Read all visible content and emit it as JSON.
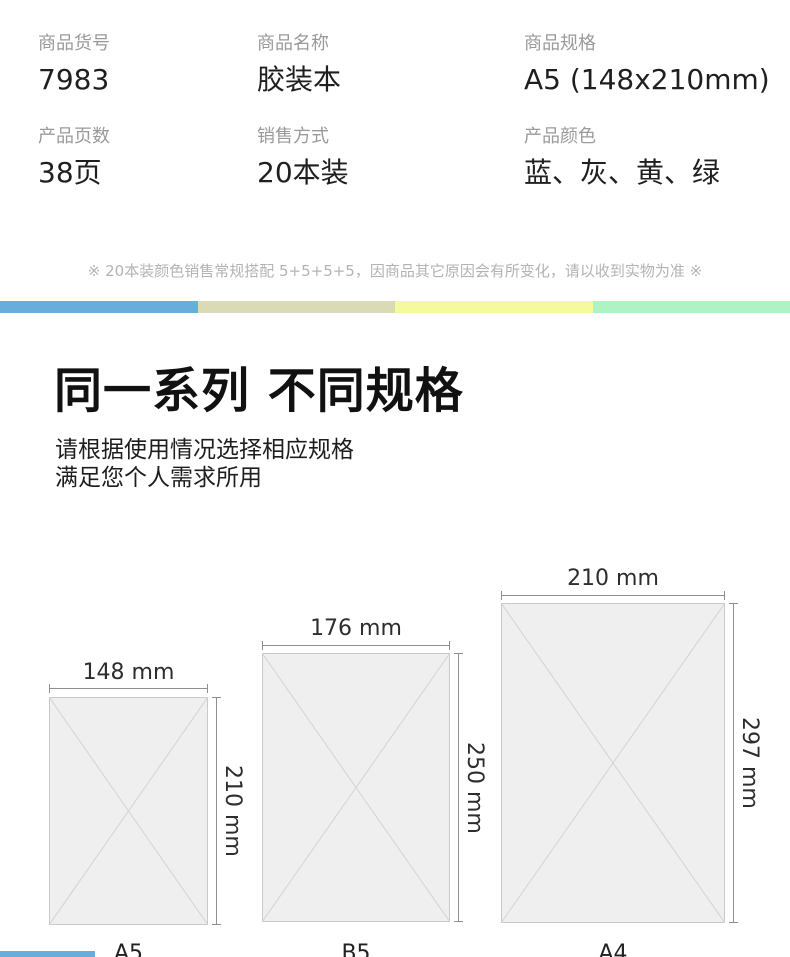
{
  "specs": {
    "rows": [
      [
        {
          "label": "商品货号",
          "value": "7983"
        },
        {
          "label": "商品名称",
          "value": "胶装本"
        },
        {
          "label": "商品规格",
          "value": "A5 (148x210mm)"
        }
      ],
      [
        {
          "label": "产品页数",
          "value": "38页"
        },
        {
          "label": "销售方式",
          "value": "20本装"
        },
        {
          "label": "产品颜色",
          "value": "蓝、灰、黄、绿"
        }
      ]
    ]
  },
  "note": "※ 20本装颜色销售常规搭配 5+5+5+5，因商品其它原因会有所变化，请以收到实物为准 ※",
  "divider_colors": [
    "#68aedd",
    "#dbdab6",
    "#f6fa9f",
    "#aff2c4"
  ],
  "section": {
    "title": "同一系列 不同规格",
    "subtitle_line1": "请根据使用情况选择相应规格",
    "subtitle_line2": "满足您个人需求所用"
  },
  "sizes": [
    {
      "name": "A5",
      "width_label": "148 mm",
      "height_label": "210 mm"
    },
    {
      "name": "B5",
      "width_label": "176 mm",
      "height_label": "250 mm"
    },
    {
      "name": "A4",
      "width_label": "210 mm",
      "height_label": "297 mm"
    }
  ]
}
